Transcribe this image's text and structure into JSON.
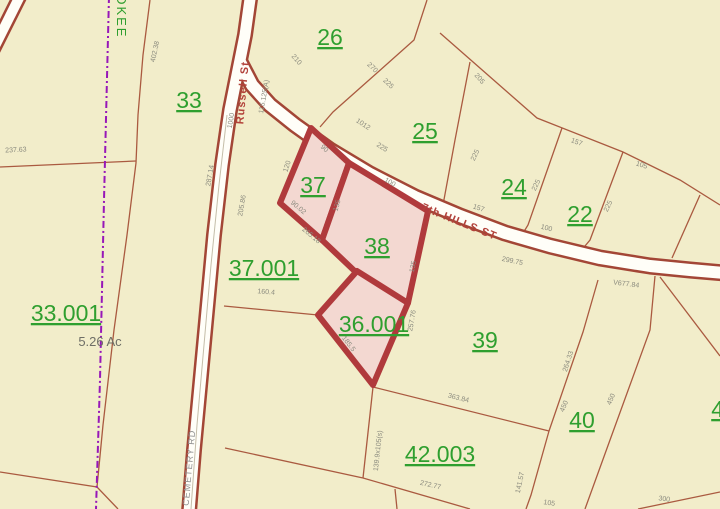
{
  "map": {
    "background_color": "#f2edca",
    "highlight_fill_color": "#f3d8d1",
    "highlight_stroke_color": "#b03a3c",
    "parcel_line_color": "#aa5a40",
    "parcel_label_color": "#2f9f2f",
    "boundary_overlay_color": "#9717b8",
    "parcel_labels": [
      {
        "id": "26",
        "text": "26",
        "x": 330,
        "y": 45
      },
      {
        "id": "33",
        "text": "33",
        "x": 189,
        "y": 108
      },
      {
        "id": "25",
        "text": "25",
        "x": 425,
        "y": 139
      },
      {
        "id": "24",
        "text": "24",
        "x": 514,
        "y": 195
      },
      {
        "id": "22",
        "text": "22",
        "x": 580,
        "y": 222
      },
      {
        "id": "37",
        "text": "37",
        "x": 313,
        "y": 193
      },
      {
        "id": "38",
        "text": "38",
        "x": 377,
        "y": 254
      },
      {
        "id": "37.001",
        "text": "37.001",
        "x": 264,
        "y": 276
      },
      {
        "id": "36.001",
        "text": "36.001",
        "x": 374,
        "y": 332
      },
      {
        "id": "33.001",
        "text": "33.001",
        "x": 66,
        "y": 321
      },
      {
        "id": "39",
        "text": "39",
        "x": 485,
        "y": 348
      },
      {
        "id": "40",
        "text": "40",
        "x": 582,
        "y": 428
      },
      {
        "id": "42.003",
        "text": "42.003",
        "x": 440,
        "y": 462
      },
      {
        "id": "41",
        "text": "41",
        "x": 724,
        "y": 417
      }
    ],
    "area_label": {
      "text": "5.26 Ac",
      "x": 100,
      "y": 346
    },
    "street_labels": [
      {
        "name": "street-label-russell-st",
        "text": "Russell St",
        "x": 246,
        "y": 93,
        "r": -85,
        "size": 11,
        "color": "#b2423a",
        "bold": true,
        "spacing": 1
      },
      {
        "name": "street-label-7th-hills-st",
        "text": "7th HILLS ST",
        "x": 458,
        "y": 225,
        "r": 22,
        "size": 11,
        "color": "#b2423a",
        "bold": true,
        "spacing": 1
      },
      {
        "name": "street-label-cemetery-rd",
        "text": "CEMETERY RD",
        "x": 192,
        "y": 468,
        "r": -85,
        "size": 9,
        "color": "#8f8f8f",
        "bold": false,
        "spacing": 1
      },
      {
        "name": "street-label-cherokee",
        "text": "CHEROKEE",
        "x": 117,
        "y": -6,
        "r": 90,
        "size": 13,
        "color": "#2e9e2e",
        "bold": false,
        "spacing": 2,
        "anchor": "start"
      }
    ],
    "dimension_labels": [
      {
        "t": "402.38",
        "x": 157,
        "y": 52,
        "r": -78
      },
      {
        "t": "237.63",
        "x": 16,
        "y": 152,
        "r": -3
      },
      {
        "t": "1000",
        "x": 233,
        "y": 121,
        "r": -80
      },
      {
        "t": "115.125(A)",
        "x": 266,
        "y": 97,
        "r": -80
      },
      {
        "t": "287.14",
        "x": 212,
        "y": 176,
        "r": -80
      },
      {
        "t": "205.86",
        "x": 244,
        "y": 206,
        "r": -80
      },
      {
        "t": "210",
        "x": 295,
        "y": 61,
        "r": 48
      },
      {
        "t": "1012",
        "x": 362,
        "y": 126,
        "r": 33
      },
      {
        "t": "225",
        "x": 381,
        "y": 149,
        "r": 33
      },
      {
        "t": "270",
        "x": 371,
        "y": 69,
        "r": 44
      },
      {
        "t": "225",
        "x": 387,
        "y": 85,
        "r": 44
      },
      {
        "t": "205",
        "x": 478,
        "y": 80,
        "r": 48
      },
      {
        "t": "225",
        "x": 477,
        "y": 156,
        "r": -65
      },
      {
        "t": "157",
        "x": 576,
        "y": 144,
        "r": 20
      },
      {
        "t": "225",
        "x": 538,
        "y": 186,
        "r": -65
      },
      {
        "t": "105",
        "x": 641,
        "y": 167,
        "r": 18
      },
      {
        "t": "225",
        "x": 610,
        "y": 207,
        "r": -65
      },
      {
        "t": "100",
        "x": 546,
        "y": 230,
        "r": 14
      },
      {
        "t": "157",
        "x": 478,
        "y": 210,
        "r": 18
      },
      {
        "t": "299.75",
        "x": 512,
        "y": 263,
        "r": 12
      },
      {
        "t": "V677.84",
        "x": 626,
        "y": 286,
        "r": 7
      },
      {
        "t": "90",
        "x": 323,
        "y": 150,
        "r": 42
      },
      {
        "t": "120",
        "x": 289,
        "y": 167,
        "r": -72
      },
      {
        "t": "90.02",
        "x": 297,
        "y": 209,
        "r": 40
      },
      {
        "t": "265.18",
        "x": 310,
        "y": 237,
        "r": 40
      },
      {
        "t": "135",
        "x": 339,
        "y": 206,
        "r": -74
      },
      {
        "t": "100",
        "x": 389,
        "y": 184,
        "r": 30
      },
      {
        "t": "135",
        "x": 415,
        "y": 267,
        "r": -78
      },
      {
        "t": "257.76",
        "x": 414,
        "y": 321,
        "r": -80
      },
      {
        "t": "185.5",
        "x": 347,
        "y": 345,
        "r": 52
      },
      {
        "t": "160.4",
        "x": 266,
        "y": 294,
        "r": 5
      },
      {
        "t": "363.84",
        "x": 458,
        "y": 400,
        "r": 14
      },
      {
        "t": "139.9x105(s)",
        "x": 380,
        "y": 451,
        "r": -84
      },
      {
        "t": "272.77",
        "x": 430,
        "y": 487,
        "r": 13
      },
      {
        "t": "141.57",
        "x": 522,
        "y": 483,
        "r": -78
      },
      {
        "t": "264.33",
        "x": 570,
        "y": 362,
        "r": -72
      },
      {
        "t": "450",
        "x": 566,
        "y": 407,
        "r": -68
      },
      {
        "t": "450",
        "x": 613,
        "y": 400,
        "r": -68
      },
      {
        "t": "300",
        "x": 664,
        "y": 501,
        "r": 7
      },
      {
        "t": "105",
        "x": 549,
        "y": 505,
        "r": 8
      }
    ],
    "highlight_parcels": [
      {
        "id": "37",
        "points": "311,128 349,163 322,240 280,203"
      },
      {
        "id": "38",
        "points": "349,163 428,211 408,303 362,278 322,240"
      },
      {
        "id": "36.001",
        "points": "357,271 408,303 373,385 318,315"
      }
    ],
    "parcel_lines": [
      "150,0 143,55 138,115 136,163 127,235 114,330 103,425 97,487",
      "0,167 136,161",
      "0,472 97,487 118,509",
      "427,0 414,40 333,112 320,127",
      "440,33 537,118 623,152 680,180 720,205",
      "470,62 455,140 443,205",
      "562,128 528,225 517,243",
      "623,152 590,240 580,252",
      "700,195 672,258",
      "224,306 318,315",
      "598,280 583,332 549,431",
      "549,431 373,387",
      "549,431 531,495 526,509",
      "373,387 363,478",
      "363,478 470,509",
      "395,489 397,509",
      "225,448 363,478",
      "655,276 650,330 610,440 585,509",
      "660,277 720,356",
      "638,509 720,492"
    ],
    "city_boundary_line": {
      "points": "109,-4 104,200 100,380 96,509"
    },
    "roads": [
      {
        "name": "road-russell-cemetery",
        "points": "251,-8 245,35 237,75 230,110 222,165 214,235 208,300 201,375 194,450 189,512",
        "casing": 16,
        "fill": 11
      },
      {
        "name": "road-7th-hills",
        "points": "240,62 252,85 270,105 295,125 330,150 370,174 415,197 460,216 505,233 550,246 600,258 650,266 690,270 724,273",
        "casing": 17,
        "fill": 12
      },
      {
        "name": "road-corner",
        "points": "22,-8 -8,52",
        "casing": 15,
        "fill": 10
      }
    ],
    "road_inner_line": "227,115 219,185 211,265 204,345 197,425 191,509"
  }
}
